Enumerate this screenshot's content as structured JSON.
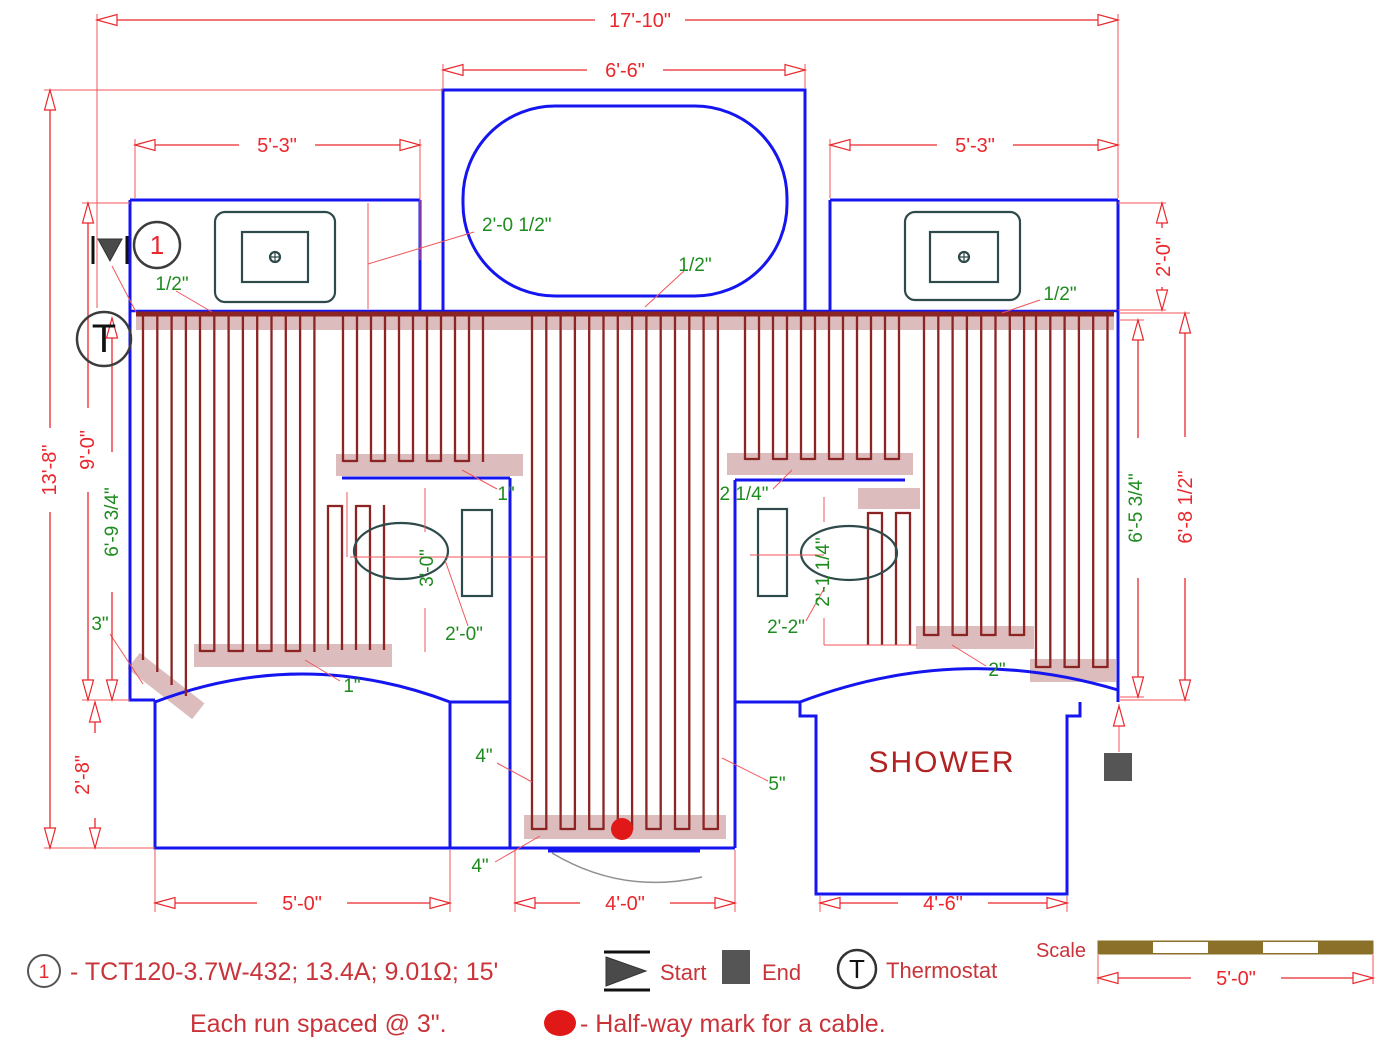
{
  "title": "Floor heating cable layout plan",
  "colors": {
    "dimension_red": "#ea272c",
    "annotation_green": "#1e8b1e",
    "wall_blue": "#1515f0",
    "cable_maroon": "#8b2423",
    "highlight_rose": "#c08585",
    "legend_red": "#c9343a",
    "scale_brown": "#8a7028",
    "marker_gray": "#555555",
    "halfway_red": "#e01818"
  },
  "dims": {
    "overall_width": "17'-10\"",
    "tub_width": "6'-6\"",
    "vanity_left_width": "5'-3\"",
    "vanity_right_width": "5'-3\"",
    "overall_height": "13'-8\"",
    "left_height": "9'-0\"",
    "cable_left_height": "6'-9 3/4\"",
    "vanity_right_depth": "2'-0\"",
    "cable_right_height": "6'-5 3/4\"",
    "right_height": "6'-8 1/2\"",
    "left_room_drop": "2'-8\"",
    "left_room_width": "5'-0\"",
    "door_width": "4'-0\"",
    "shower_width": "4'-6\"",
    "scale_bar": "5'-0\""
  },
  "annotations": {
    "sink_offset": "2'-0 1/2\"",
    "gap_left": "1/2\"",
    "gap_tub": "1/2\"",
    "gap_right": "1/2\"",
    "band_left_gap": "1\"",
    "band_right_gap": "2 1/4\"",
    "toilet_left_height": "3'-0\"",
    "toilet_left_offset": "2'-0\"",
    "toilet_right_offset": "2'-2\"",
    "toilet_right_center": "2'-1 1/4\"",
    "wall_gap": "3\"",
    "arc_gap": "1\"",
    "door_gap_left": "4\"",
    "door_gap_right": "5\"",
    "door_gap_bottom": "4\"",
    "shower_gap": "2\""
  },
  "rooms": {
    "shower": "SHOWER"
  },
  "markers": {
    "circuit": "1",
    "thermostat": "T"
  },
  "legend": {
    "circuit": "1",
    "spec": "- TCT120-3.7W-432; 13.4A; 9.01Ω; 15'",
    "start": "Start",
    "end": "End",
    "thermostat_symbol": "T",
    "thermostat": "Thermostat",
    "note_spacing": "Each run spaced @ 3\".",
    "note_halfway": "- Half-way mark for a cable.",
    "scale": "Scale"
  }
}
